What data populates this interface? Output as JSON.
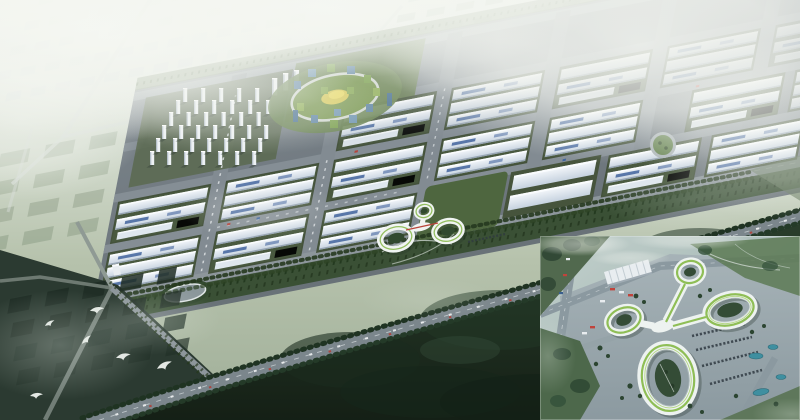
{
  "scene": {
    "title": "Hazy aerial rendering of an industrial park masterplan with a clover-shaped landmark building",
    "atmosphere": "heavy white fog over the distant city grid, clear over the central park",
    "regions": {
      "distant_city": {
        "label": "fog-covered low-rise city blocks",
        "fog_level": "heavy"
      },
      "residential_cluster": {
        "label": "grid of white residential slab towers",
        "tower_count": 41
      },
      "campus_cluster": {
        "label": "circular mixed-use campus with oval ring road",
        "center_accent": "#d6c95a",
        "glass_color": "#4e7494",
        "green_roof_color": "#7ba04f"
      },
      "industrial_park": {
        "label": "rows of white factory halls on a grey road grid",
        "block_count": 18,
        "building_color": "#e9eef4",
        "skylight_color": "#41639c",
        "hedge_color": "#44523b"
      },
      "clover_building": {
        "label": "white looped landmark building",
        "loop_count": 3,
        "roof_stripe_color": "#8cba52",
        "red_accent": "#b8453a"
      },
      "oval_pond": {
        "label": "oval track-like plaza"
      },
      "roundabout": {
        "label": "green circular roundabout"
      },
      "highway": {
        "label": "tree-lined diagonal highway with traffic"
      },
      "forest": {
        "label": "dark forest belt along the lower edge"
      },
      "birds": {
        "label": "white birds flying over dark fields",
        "count": 6
      }
    }
  },
  "inset": {
    "label": "close-up aerial view of the clover landmark building complex",
    "position": "bottom-right corner",
    "loop_count": 4,
    "roof_stripe_color": "#8abc4e",
    "features": [
      "white ring wings with green roof stripes",
      "inner tree courtyards",
      "parking rows with cars",
      "long white ribbed warehouse shed",
      "teal ponds",
      "fog wisps"
    ]
  },
  "palette": {
    "fog_white": "#f2f5f0",
    "pale_field": "#b3bfae",
    "distant_slab": "#cdd7da",
    "park_ground": "#727c82",
    "road_grey": "#8d969b",
    "building_white": "#e9eef4",
    "roof_blue": "#41639c",
    "hedge_green": "#44523b",
    "landscape_green": "#4e663f",
    "forest_dark": "#16251a",
    "inset_mist": "#b7c8c4",
    "pond_teal": "#3f8fa0",
    "stripe_green": "#8abc4e"
  }
}
